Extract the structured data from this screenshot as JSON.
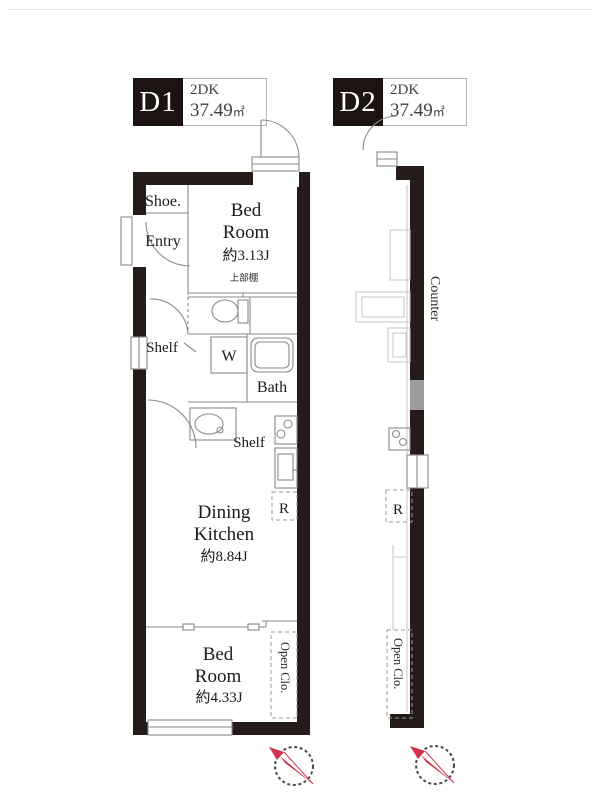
{
  "units": [
    {
      "id": "D1",
      "type": "2DK",
      "area": "37.49",
      "area_unit": "㎡"
    },
    {
      "id": "D2",
      "type": "2DK",
      "area": "37.49",
      "area_unit": "㎡"
    }
  ],
  "plan_d1": {
    "shoe": "Shoe.",
    "entry": "Entry",
    "bedroom1": {
      "line1": "Bed",
      "line2": "Room",
      "size": "約3.13J",
      "upper_shelf": "上部棚"
    },
    "shelf_left": "Shelf",
    "washer": "W",
    "bath": "Bath",
    "shelf_kitchen": "Shelf",
    "fridge": "R",
    "dk": {
      "line1": "Dining",
      "line2": "Kitchen",
      "size": "約8.84J"
    },
    "bedroom2": {
      "line1": "Bed",
      "line2": "Room",
      "size": "約4.33J"
    },
    "open_closet": "Open Clo."
  },
  "plan_d2": {
    "counter": "Counter",
    "fridge": "R",
    "open_closet": "Open Clo."
  },
  "colors": {
    "wall": "#251b18",
    "thin_line": "#8a8a8a",
    "faint_line": "#c6c6c6",
    "compass_red": "#cf3350"
  }
}
